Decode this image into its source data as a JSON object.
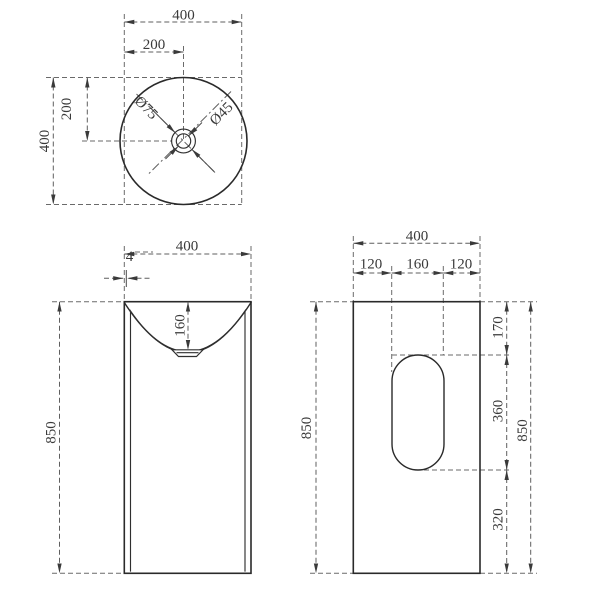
{
  "colors": {
    "outline": "#2a2a2a",
    "dimension_lines": "#5f5f5f",
    "label_text": "#3a3a3a",
    "background": "#ffffff"
  },
  "top_view": {
    "width": "400",
    "drain_offset_x": "200",
    "depth": "400",
    "drain_offset_y": "200",
    "drain_outer_diameter": "Ø75",
    "drain_inner_diameter": "Ø45"
  },
  "front_view": {
    "width": "400",
    "rim_thickness": "4",
    "bowl_depth": "160",
    "height": "850"
  },
  "side_view": {
    "width": "400",
    "segment_left": "120",
    "segment_middle": "160",
    "segment_right": "120",
    "height": "850",
    "cutout_top_offset": "170",
    "cutout_height": "360",
    "cutout_bottom_offset": "320",
    "overall_height": "850"
  }
}
